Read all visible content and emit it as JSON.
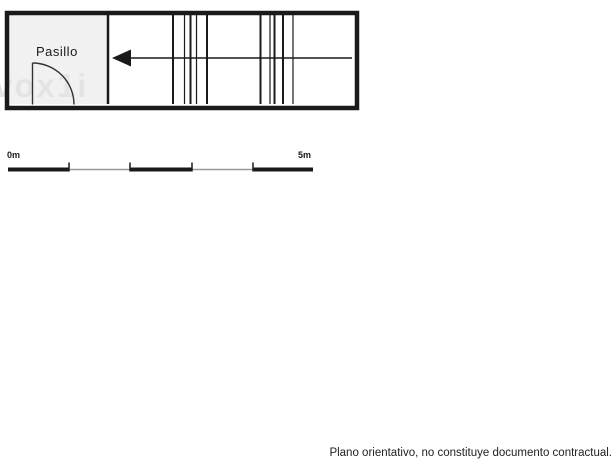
{
  "plan": {
    "room_label": "Pasillo",
    "watermark": "vox1i"
  },
  "scale_bar": {
    "start_label": "0m",
    "end_label": "5m",
    "length_meters": 5
  },
  "footer": {
    "disclaimer": "Plano orientativo, no constituye documento contractual."
  },
  "colors": {
    "line": "#1a1a1a",
    "room_fill": "#f1f1f1",
    "scale_thin": "#999999",
    "watermark": "#e4e4e4"
  }
}
